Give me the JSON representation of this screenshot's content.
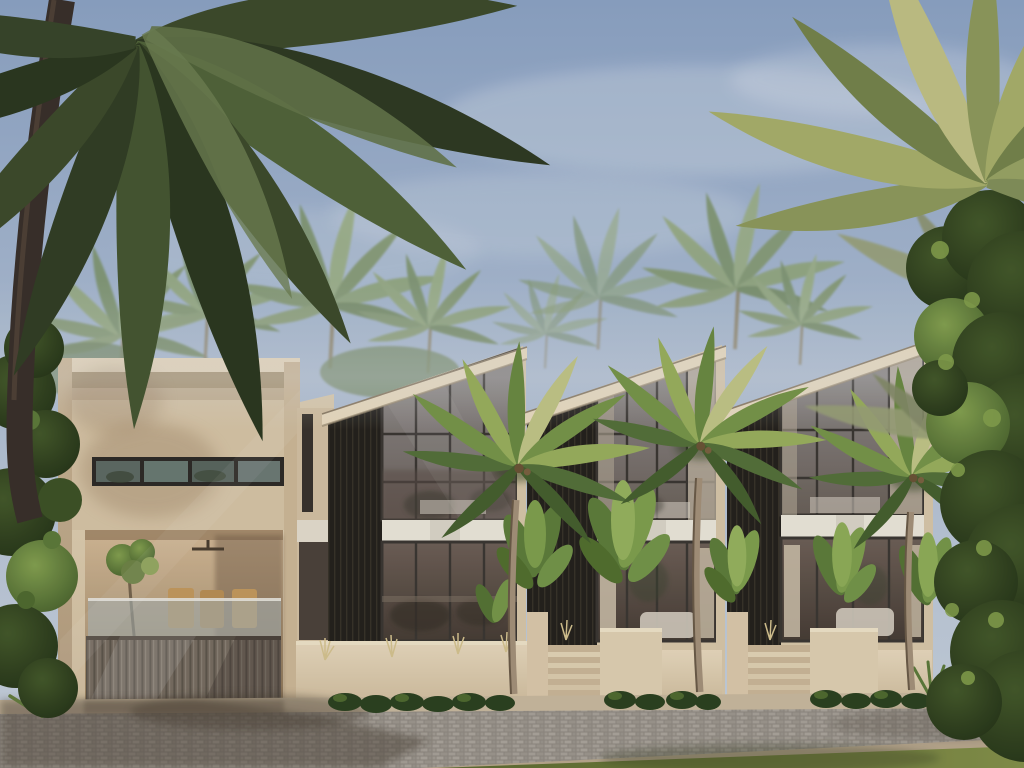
{
  "scene": {
    "description": "Photorealistic daytime architectural rendering of a modern tropical villa complex: a flat-roof beige villa on the left with a slatted garage gate and open terrace, joined by three identical shed-roof townhouse units with tall black-framed glass facades, dark vertical wood-slat panels and a white inter-floor band, fronted by beige planter walls, entry steps, palms and tropical plants along a cobblestone street",
    "time_of_day": "late afternoon, hazy sunny sky",
    "style": "3D render, warm tropical minimalism",
    "no_visible_text": true
  },
  "palette": {
    "sky_top": "#8ca3c4",
    "sky_horizon": "#c9d2dd",
    "wall_sunlit": "#e3d3b7",
    "wall_shaded": "#c3ad8e",
    "white_band": "#ece7da",
    "dark_slats": "#24211d",
    "glass_upper": "#837d7a",
    "glass_lower": "#55493f",
    "curtain": "#c9bca6",
    "road": "#a29c93",
    "sidewalk": "#c9b99e",
    "grass": "#72803e",
    "palm_frond_dark": "#3d4b2b",
    "palm_frond_light": "#9ab05e",
    "foliage_dark": "#2c3d1e",
    "foliage_light": "#7fa04e",
    "trunk": "#a4917a"
  },
  "composition": {
    "sky": "hazy blue sky with soft white cloud wisps, haze increasing toward horizon",
    "background": "row of hazy coconut palms behind the rooflines",
    "buildings": [
      {
        "name": "left-flat-roof-villa",
        "features": [
          "framed parapet with recessed upper panel",
          "horizontal strip window with 4 panes",
          "open terrace with ceiling fan, small tree, dining chairs and glass balustrade",
          "vertical-slat garage gate"
        ]
      },
      {
        "name": "shed-roof-unit-1",
        "features": [
          "beige sloped fascia rising to right peak",
          "dark vertical slat panel on left",
          "two-storey glass wall with black mullions",
          "white band between floors",
          "low beige fence wall with shrubs and dry grass tufts"
        ]
      },
      {
        "name": "shed-roof-unit-2",
        "features": [
          "same shed-roof design",
          "curtained ground-floor glass with white sofa glimpse",
          "entry steps with flanking planter walls and banana plants"
        ]
      },
      {
        "name": "shed-roof-unit-3",
        "features": [
          "same shed-roof design",
          "entry steps",
          "planter walls with banana plants",
          "agave cluster at right"
        ]
      }
    ],
    "vegetation": [
      "large coconut palm overhanging from top-left corner",
      "yellow-green palm crown at top-right",
      "dense leafy tree filling the right edge",
      "three street palms in front of the units",
      "banana plants in planters",
      "low shrub rows",
      "agaves",
      "dark foliage along the left edge"
    ],
    "street": "light gray cobblestone pavers, tan sidewalk and curb, green grass strip in the foreground, long palm shadows crossing the road"
  },
  "counts": {
    "shed_roof_units": 3,
    "street_palms": 3,
    "strip_window_panes": 4,
    "entry_stairs": 2
  }
}
